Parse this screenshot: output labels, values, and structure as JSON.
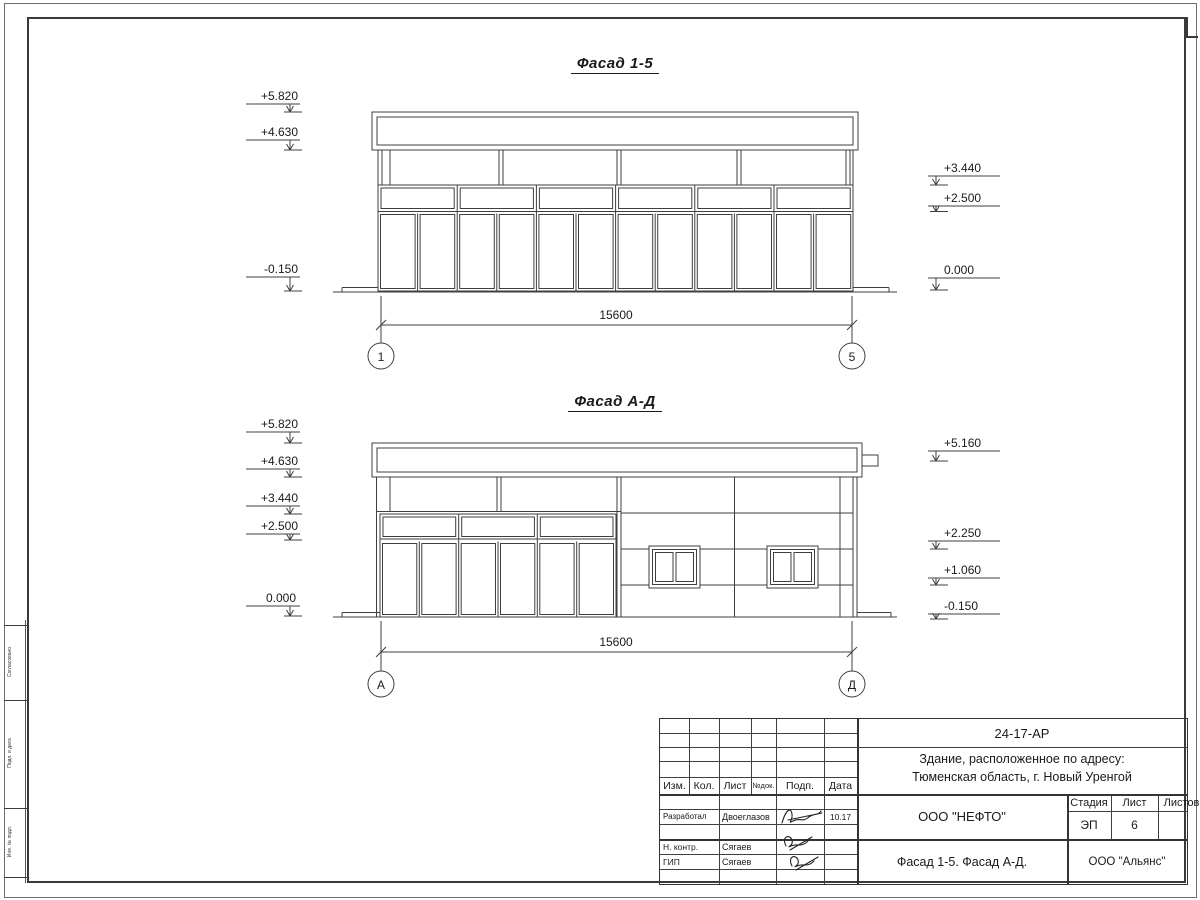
{
  "facade15": {
    "title": "Фасад 1-5",
    "elev_left": [
      "+5.820",
      "+4.630",
      "-0.150"
    ],
    "elev_right": [
      "+3.440",
      "+2.500",
      "0.000"
    ],
    "dimension": "15600",
    "axis_left": "1",
    "axis_right": "5"
  },
  "facadeAD": {
    "title": "Фасад А-Д",
    "elev_left": [
      "+5.820",
      "+4.630",
      "+3.440",
      "+2.500",
      "0.000"
    ],
    "elev_right": [
      "+5.160",
      "+2.250",
      "+1.060",
      "-0.150"
    ],
    "dimension": "15600",
    "axis_left": "А",
    "axis_right": "Д"
  },
  "side_stamp": {
    "labels": [
      "Согласовано",
      "Подп. и дата",
      "Инв. № подл."
    ]
  },
  "titleblock": {
    "doc_number": "24-17-АР",
    "object_line1": "Здание, расположенное по адресу:",
    "object_line2": "Тюменская область, г. Новый Уренгой",
    "cols": {
      "izm": "Изм.",
      "kol": "Кол.",
      "list": "Лист",
      "ndok": "№док.",
      "podp": "Подп.",
      "data": "Дата"
    },
    "rows": [
      {
        "role": "Разработал",
        "name": "Двоеглазов",
        "date": "10.17"
      },
      {
        "role": "Н. контр.",
        "name": "Сягаев",
        "date": ""
      },
      {
        "role": "ГИП",
        "name": "Сягаев",
        "date": ""
      }
    ],
    "designer": "ООО \"НЕФТО\"",
    "stage_label": "Стадия",
    "sheet_label": "Лист",
    "sheets_label": "Листов",
    "stage": "ЭП",
    "sheet_no": "6",
    "sheets_total": "",
    "sheet_title": "Фасад 1-5. Фасад А-Д.",
    "contractor": "ООО \"Альянс\""
  }
}
